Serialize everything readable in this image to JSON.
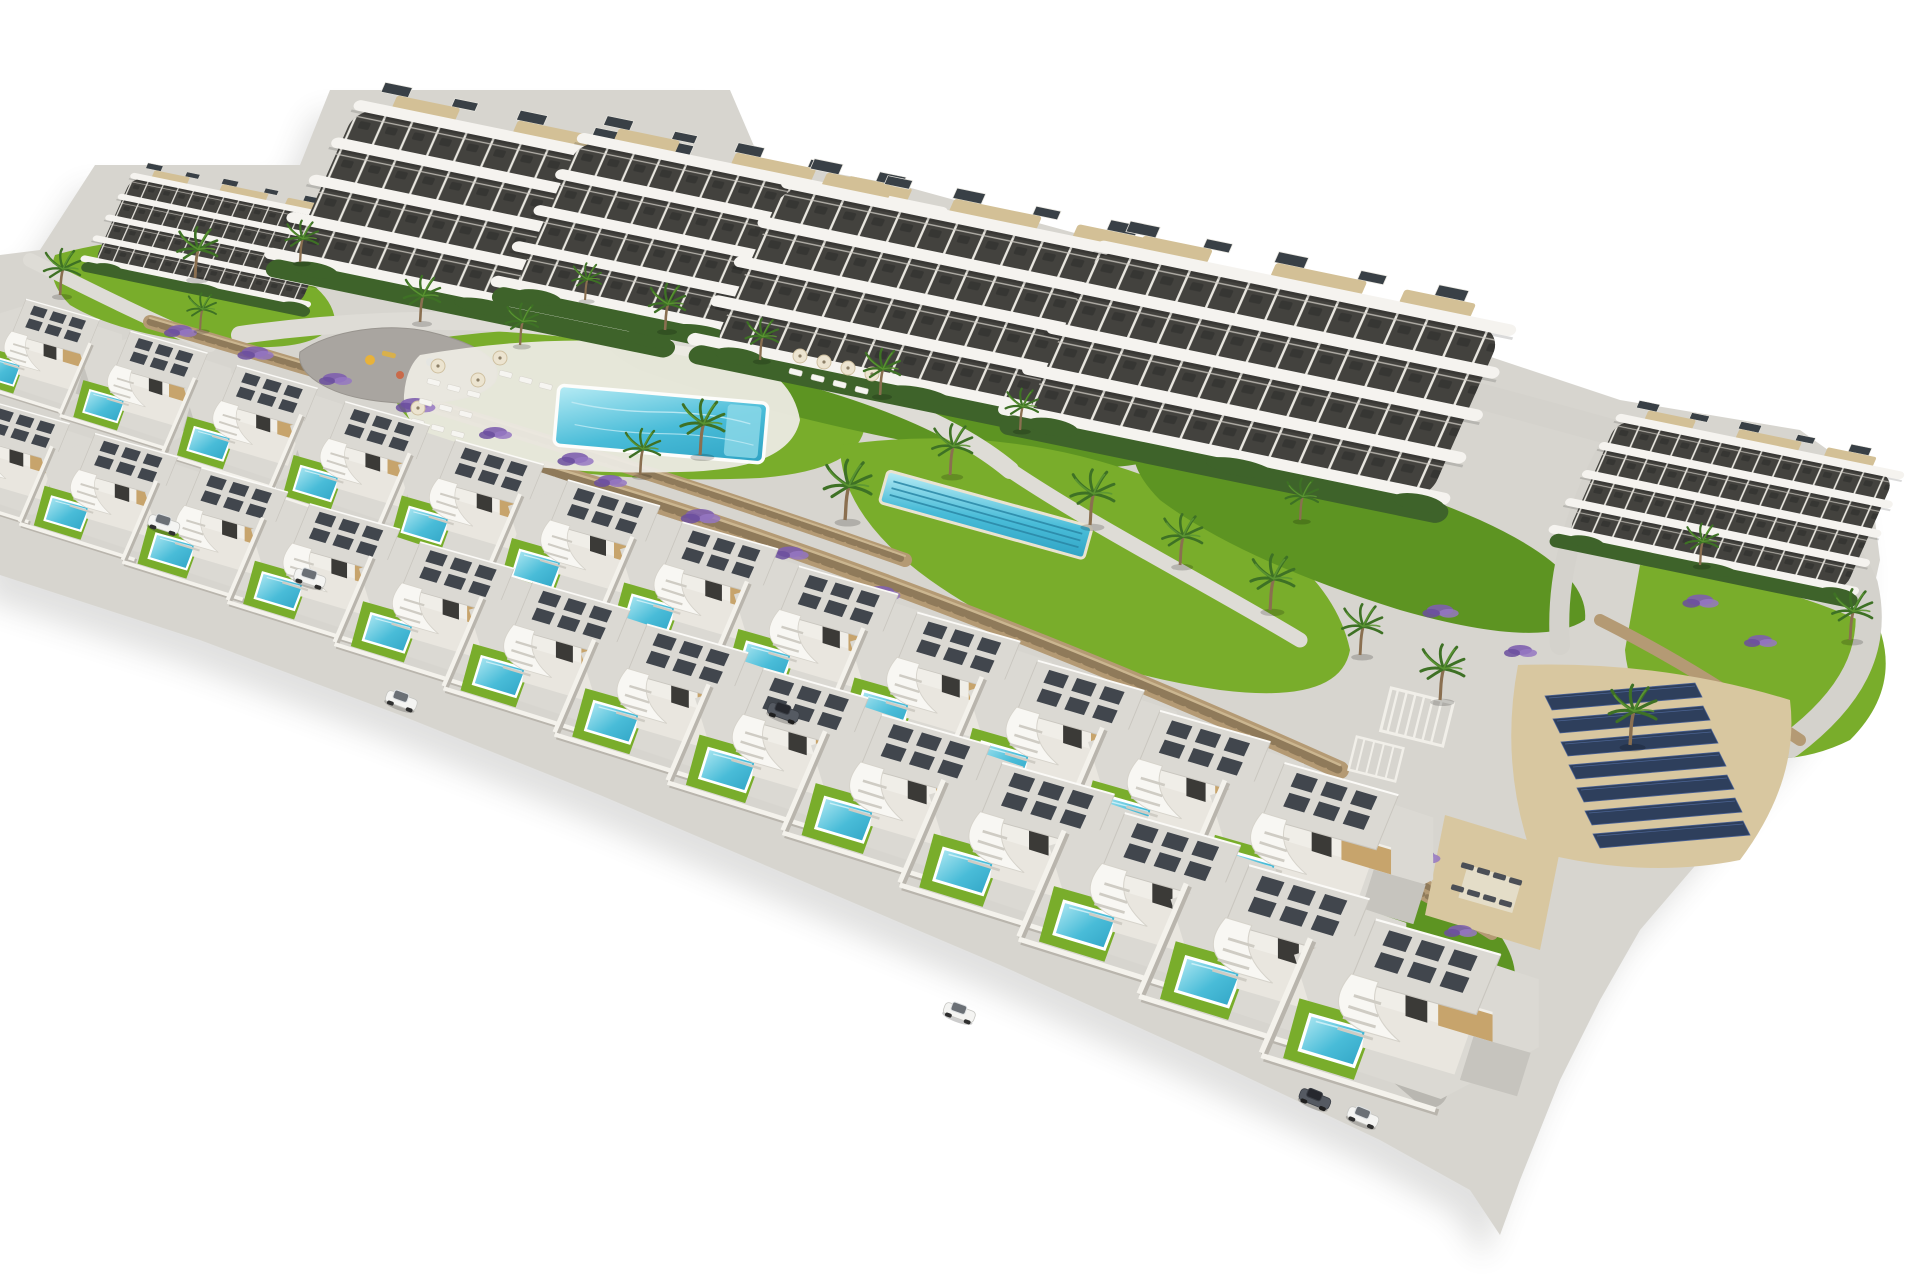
{
  "image": {
    "type": "3D architectural aerial render",
    "subject": "hillside residential development: curved-balcony apartment blocks, two diagonal rows of villas with private pools, communal pools, playground, gardens, stone terraces and a solar panel field",
    "background": "white"
  },
  "colors": {
    "terrain": "#d7d5cf",
    "plot": "#dbd9d3",
    "path": "#dedcd6",
    "road": "#b9b7b1",
    "drive": "#c6c4be",
    "lawn": "#79ad2b",
    "lawnDark": "#5d9422",
    "hedge": "#3e632a",
    "stone": "#b49a74",
    "stoneDark": "#8f7a5a",
    "stoneLight": "#cbb690",
    "pool": "#49bcd8",
    "poolLight": "#b8ecf5",
    "poolDark": "#2a87a6",
    "building": "#f5f3ef",
    "buildingShade": "#c6c3bb",
    "window": "#43423e",
    "deck": "#d3c096",
    "villaRoof": "#dbd9d3",
    "heater": "#41464d",
    "wood": "#c7a46c",
    "panel": "#2e3f5c",
    "flower": "#7e5fae",
    "palm": "#3e7125",
    "trunk": "#8a6f50",
    "sand": "#d8c7a0",
    "shadow": "#4a4a46"
  },
  "scene": {
    "instances": [
      {
        "layer": "apartments-layer",
        "symbol": "apt",
        "items": [
          {
            "x": 135,
            "y": 170,
            "s": 0.52
          },
          {
            "x": 362,
            "y": 95,
            "s": 0.93
          },
          {
            "x": 585,
            "y": 128,
            "s": 0.9
          },
          {
            "x": 790,
            "y": 172,
            "s": 0.98
          },
          {
            "x": 1105,
            "y": 235,
            "s": 1.02
          },
          {
            "x": 1622,
            "y": 410,
            "s": 0.7
          }
        ]
      },
      {
        "layer": "palms-layer",
        "symbol": "palm",
        "items": [
          {
            "x": 60,
            "y": 295,
            "s": 1.0
          },
          {
            "x": 195,
            "y": 278,
            "s": 1.1
          },
          {
            "x": 300,
            "y": 262,
            "s": 0.9
          },
          {
            "x": 420,
            "y": 322,
            "s": 1.0
          },
          {
            "x": 520,
            "y": 345,
            "s": 0.9
          },
          {
            "x": 585,
            "y": 300,
            "s": 0.8
          },
          {
            "x": 665,
            "y": 330,
            "s": 1.0
          },
          {
            "x": 700,
            "y": 455,
            "s": 1.2
          },
          {
            "x": 760,
            "y": 360,
            "s": 0.9
          },
          {
            "x": 845,
            "y": 520,
            "s": 1.3
          },
          {
            "x": 880,
            "y": 395,
            "s": 1.0
          },
          {
            "x": 950,
            "y": 475,
            "s": 1.1
          },
          {
            "x": 1020,
            "y": 430,
            "s": 0.9
          },
          {
            "x": 1090,
            "y": 525,
            "s": 1.2
          },
          {
            "x": 1180,
            "y": 565,
            "s": 1.1
          },
          {
            "x": 1270,
            "y": 610,
            "s": 1.2
          },
          {
            "x": 1360,
            "y": 655,
            "s": 1.1
          },
          {
            "x": 1300,
            "y": 520,
            "s": 0.9
          },
          {
            "x": 1440,
            "y": 700,
            "s": 1.2
          },
          {
            "x": 1630,
            "y": 745,
            "s": 1.3
          },
          {
            "x": 1850,
            "y": 640,
            "s": 1.1
          },
          {
            "x": 1700,
            "y": 565,
            "s": 0.9
          },
          {
            "x": 640,
            "y": 475,
            "s": 1.0
          },
          {
            "x": 200,
            "y": 330,
            "s": 0.8
          }
        ]
      },
      {
        "layer": "flowers-layer",
        "symbol": "flower",
        "items": [
          {
            "x": 180,
            "y": 330,
            "s": 1.0
          },
          {
            "x": 255,
            "y": 352,
            "s": 1.1
          },
          {
            "x": 335,
            "y": 378,
            "s": 1.0
          },
          {
            "x": 415,
            "y": 404,
            "s": 1.2
          },
          {
            "x": 495,
            "y": 432,
            "s": 1.0
          },
          {
            "x": 575,
            "y": 458,
            "s": 1.1
          },
          {
            "x": 610,
            "y": 480,
            "s": 1.0
          },
          {
            "x": 700,
            "y": 515,
            "s": 1.2
          },
          {
            "x": 790,
            "y": 552,
            "s": 1.1
          },
          {
            "x": 880,
            "y": 592,
            "s": 1.2
          },
          {
            "x": 970,
            "y": 634,
            "s": 1.1
          },
          {
            "x": 1060,
            "y": 676,
            "s": 1.2
          },
          {
            "x": 1150,
            "y": 718,
            "s": 1.1
          },
          {
            "x": 1240,
            "y": 760,
            "s": 1.2
          },
          {
            "x": 1330,
            "y": 805,
            "s": 1.1
          },
          {
            "x": 1420,
            "y": 855,
            "s": 1.2
          },
          {
            "x": 1300,
            "y": 830,
            "s": 1.0
          },
          {
            "x": 1380,
            "y": 890,
            "s": 1.1
          },
          {
            "x": 1460,
            "y": 930,
            "s": 1.0
          },
          {
            "x": 430,
            "y": 248,
            "s": 1.0
          },
          {
            "x": 540,
            "y": 268,
            "s": 1.1
          },
          {
            "x": 690,
            "y": 300,
            "s": 1.0
          },
          {
            "x": 850,
            "y": 340,
            "s": 1.1
          },
          {
            "x": 1000,
            "y": 382,
            "s": 1.0
          },
          {
            "x": 1440,
            "y": 610,
            "s": 1.1
          },
          {
            "x": 1520,
            "y": 650,
            "s": 1.0
          },
          {
            "x": 1700,
            "y": 600,
            "s": 1.1
          },
          {
            "x": 1760,
            "y": 640,
            "s": 1.0
          }
        ]
      },
      {
        "layer": "parasols-layer",
        "symbol": "parasol",
        "items": [
          {
            "x": 438,
            "y": 366
          },
          {
            "x": 478,
            "y": 380
          },
          {
            "x": 418,
            "y": 408
          },
          {
            "x": 500,
            "y": 358
          },
          {
            "x": 800,
            "y": 356
          },
          {
            "x": 824,
            "y": 362
          },
          {
            "x": 848,
            "y": 368
          },
          {
            "x": 872,
            "y": 374
          }
        ]
      },
      {
        "layer": "loungers-layer",
        "symbol": "lounger",
        "items": [
          {
            "x": 428,
            "y": 378,
            "rot": 14
          },
          {
            "x": 448,
            "y": 384,
            "rot": 14
          },
          {
            "x": 468,
            "y": 390,
            "rot": 14
          },
          {
            "x": 420,
            "y": 398,
            "rot": 14
          },
          {
            "x": 440,
            "y": 404,
            "rot": 14
          },
          {
            "x": 460,
            "y": 410,
            "rot": 14
          },
          {
            "x": 412,
            "y": 418,
            "rot": 14
          },
          {
            "x": 432,
            "y": 424,
            "rot": 14
          },
          {
            "x": 452,
            "y": 430,
            "rot": 14
          },
          {
            "x": 500,
            "y": 370,
            "rot": 14
          },
          {
            "x": 520,
            "y": 376,
            "rot": 14
          },
          {
            "x": 540,
            "y": 382,
            "rot": 14
          },
          {
            "x": 790,
            "y": 368,
            "rot": 14
          },
          {
            "x": 812,
            "y": 374,
            "rot": 14
          },
          {
            "x": 834,
            "y": 380,
            "rot": 14
          },
          {
            "x": 856,
            "y": 386,
            "rot": 14
          }
        ]
      },
      {
        "layer": "dark-loungers-layer",
        "symbol": "lounger-dark",
        "items": [
          {
            "x": 1462,
            "y": 862,
            "rot": 16
          },
          {
            "x": 1478,
            "y": 867,
            "rot": 16
          },
          {
            "x": 1494,
            "y": 872,
            "rot": 16
          },
          {
            "x": 1510,
            "y": 877,
            "rot": 16
          },
          {
            "x": 1452,
            "y": 884,
            "rot": 16
          },
          {
            "x": 1468,
            "y": 889,
            "rot": 16
          },
          {
            "x": 1484,
            "y": 894,
            "rot": 16
          },
          {
            "x": 1500,
            "y": 899,
            "rot": 16
          }
        ]
      },
      {
        "layer": "solar-slats-layer",
        "symbol": "solar-slat",
        "items": [
          {
            "x": 1545,
            "y": 696
          },
          {
            "x": 1553,
            "y": 719
          },
          {
            "x": 1561,
            "y": 742
          },
          {
            "x": 1569,
            "y": 765
          },
          {
            "x": 1577,
            "y": 788
          },
          {
            "x": 1585,
            "y": 811
          },
          {
            "x": 1593,
            "y": 834
          }
        ]
      },
      {
        "layer": "villas-back-layer",
        "symbol": "villa",
        "items": [
          {
            "x": 18,
            "y": 296,
            "s": 0.8
          },
          {
            "x": 122,
            "y": 328,
            "s": 0.84
          },
          {
            "x": 228,
            "y": 362,
            "s": 0.88
          },
          {
            "x": 336,
            "y": 398,
            "s": 0.92
          },
          {
            "x": 446,
            "y": 436,
            "s": 0.96
          },
          {
            "x": 558,
            "y": 476,
            "s": 1.0
          },
          {
            "x": 672,
            "y": 518,
            "s": 1.04
          },
          {
            "x": 788,
            "y": 562,
            "s": 1.08
          },
          {
            "x": 906,
            "y": 608,
            "s": 1.12
          },
          {
            "x": 1026,
            "y": 656,
            "s": 1.16
          },
          {
            "x": 1148,
            "y": 706,
            "s": 1.2
          },
          {
            "x": 1272,
            "y": 758,
            "s": 1.24
          }
        ]
      },
      {
        "layer": "villas-front-layer",
        "symbol": "villa",
        "items": [
          {
            "x": -18,
            "y": 398,
            "s": 0.86
          },
          {
            "x": 86,
            "y": 430,
            "s": 0.9
          },
          {
            "x": 192,
            "y": 464,
            "s": 0.94
          },
          {
            "x": 300,
            "y": 500,
            "s": 0.98
          },
          {
            "x": 410,
            "y": 538,
            "s": 1.02
          },
          {
            "x": 522,
            "y": 578,
            "s": 1.06
          },
          {
            "x": 636,
            "y": 620,
            "s": 1.1
          },
          {
            "x": 752,
            "y": 664,
            "s": 1.14
          },
          {
            "x": 870,
            "y": 710,
            "s": 1.18
          },
          {
            "x": 990,
            "y": 758,
            "s": 1.22
          },
          {
            "x": 1112,
            "y": 808,
            "s": 1.26
          },
          {
            "x": 1236,
            "y": 860,
            "s": 1.31
          },
          {
            "x": 1362,
            "y": 914,
            "s": 1.36
          }
        ]
      },
      {
        "layer": "cars-layer",
        "symbol": "car-white",
        "items": [
          {
            "x": 152,
            "y": 512,
            "rot": 18
          },
          {
            "x": 298,
            "y": 566,
            "rot": 18
          },
          {
            "x": 390,
            "y": 688,
            "rot": 20
          },
          {
            "x": 948,
            "y": 1000,
            "rot": 20
          },
          {
            "x": 1352,
            "y": 1104,
            "rot": 22
          }
        ]
      },
      {
        "layer": "cars-layer",
        "symbol": "car-dark",
        "items": [
          {
            "x": 772,
            "y": 700,
            "rot": 20
          },
          {
            "x": 1304,
            "y": 1086,
            "rot": 22
          }
        ]
      }
    ]
  }
}
